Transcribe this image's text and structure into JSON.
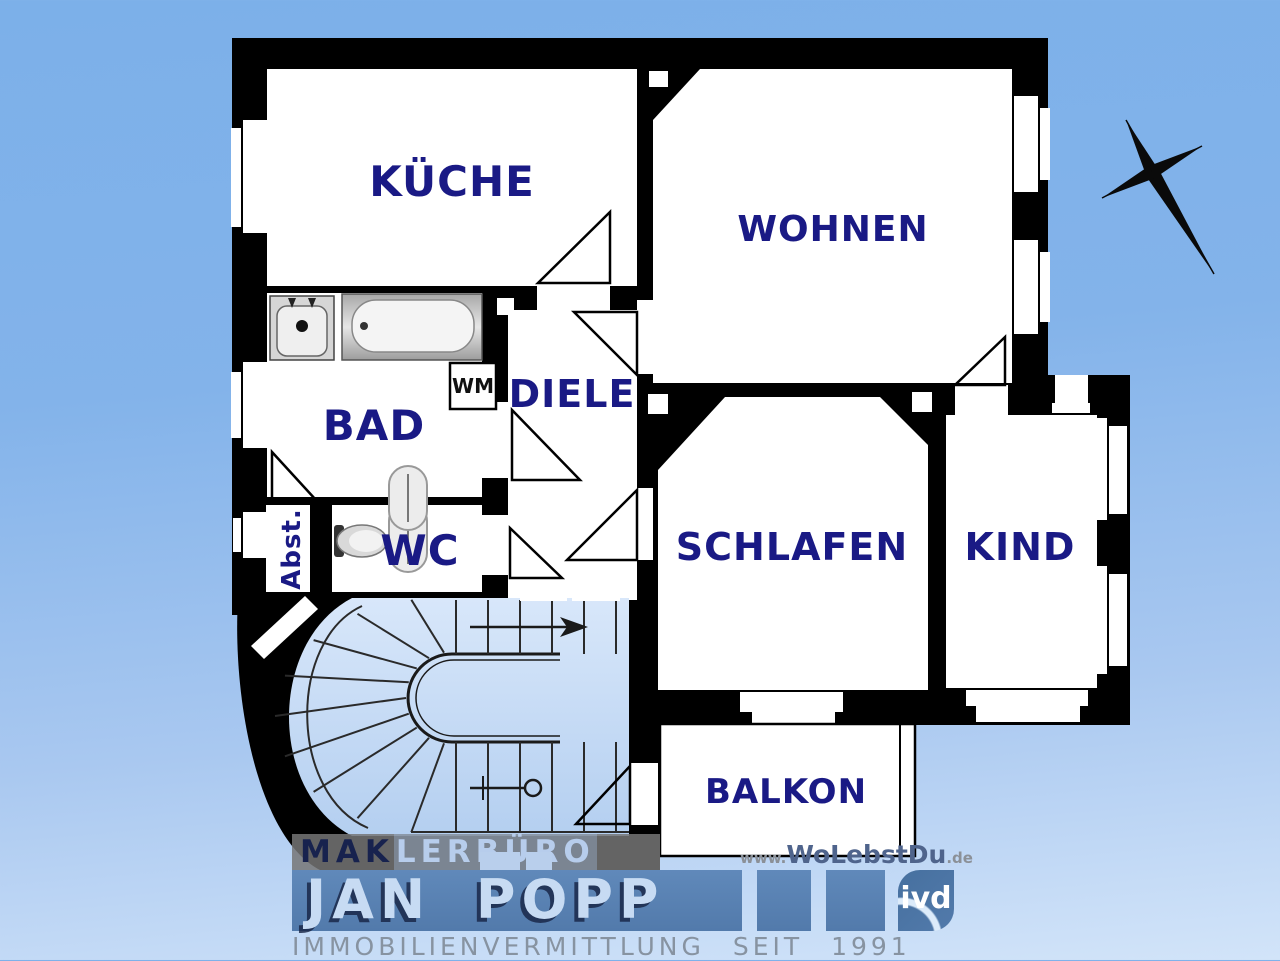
{
  "window": {
    "width": 1280,
    "height": 960
  },
  "plan": {
    "rooms": {
      "kueche": "KÜCHE",
      "wohnen": "WOHNEN",
      "diele": "DIELE",
      "bad": "BAD",
      "wc": "WC",
      "abstell": "Abst.",
      "schlafen": "SCHLAFEN",
      "kind": "KIND",
      "balkon": "BALKON",
      "waschmaschine": "WM"
    },
    "colors": {
      "wall": "#000000",
      "room_fill": "#ffffff",
      "label": "#1a1a85",
      "stair_fill_top": "#d8e7fa",
      "stair_fill_bottom": "#b4cff0",
      "background_top": "#7cb0e9",
      "background_bottom": "#d2e4f9"
    },
    "icons": {
      "compass": "compass-rose-north-arrow",
      "staircase": "winding-staircase-with-direction-arrow",
      "bathtub": "bathtub-top-view",
      "sink": "washbasin-top-view",
      "toilet": "toilet-top-view",
      "washing_machine": "washing-machine-box"
    }
  },
  "branding": {
    "agency_prefix": "MAK",
    "agency_suffix": "LERBÜRO",
    "website": {
      "prefix": "www.",
      "name": "WoLebstDu",
      "tld": ".de"
    },
    "owner": "JAN POPP",
    "association": "ivd",
    "tagline": "IMMOBILIENVERMITTLUNG SEIT 1991"
  }
}
